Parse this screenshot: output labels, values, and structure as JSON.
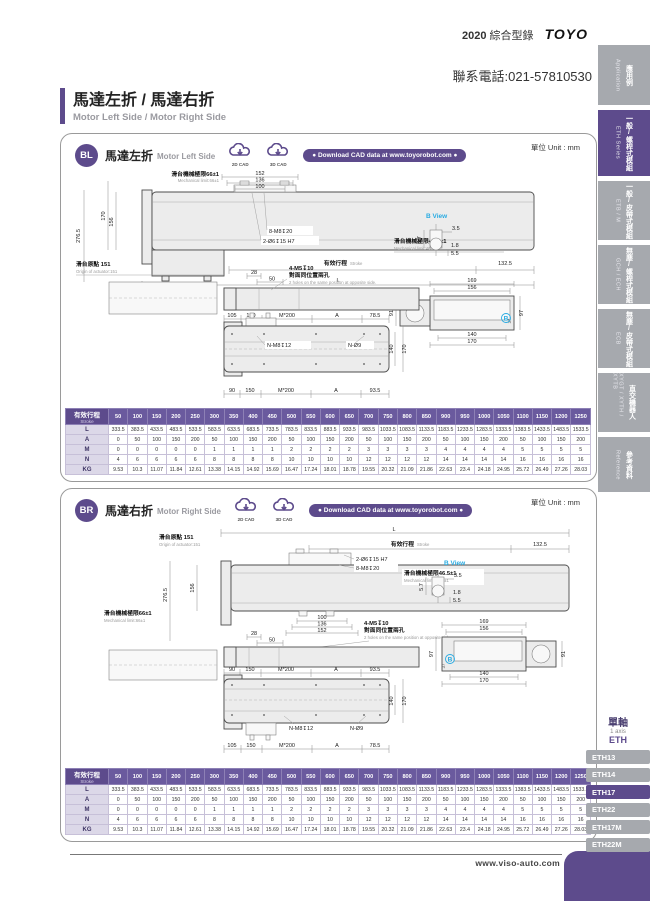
{
  "header": {
    "year": "2020",
    "catalog_zh": "綜合型錄",
    "logo": "TOYO",
    "phone": "聯系電話:021-57810530"
  },
  "title": {
    "zh": "馬達左折 / 馬達右折",
    "en": "Motor Left Side / Motor Right Side"
  },
  "sidebar_tabs": [
    {
      "zh": "應用例",
      "en": "Application"
    },
    {
      "zh": "一般/螺桿式模組",
      "en": "ETH Series"
    },
    {
      "zh": "一般/皮帶式模組",
      "en": "ETB / M"
    },
    {
      "zh": "無塵/螺桿式模組",
      "en": "GCH / ECH"
    },
    {
      "zh": "無塵/皮帶式模組",
      "en": "ECB"
    },
    {
      "zh": "直交機器人",
      "en": "XYGT / XYTH / XYTB"
    },
    {
      "zh": "參考資料",
      "en": "Reference"
    }
  ],
  "sections": [
    {
      "badge": "BL",
      "title_zh": "馬達左折",
      "title_en": "Motor Left Side",
      "unit": "單位 Unit : mm",
      "cad2d": "2D CAD",
      "cad3d": "3D CAD",
      "download": "● Download CAD data at www.toyorobot.com ●"
    },
    {
      "badge": "BR",
      "title_zh": "馬達右折",
      "title_en": "Motor Right Side",
      "unit": "單位 Unit : mm",
      "cad2d": "2D CAD",
      "cad3d": "3D CAD",
      "download": "● Download CAD data at www.toyorobot.com ●"
    }
  ],
  "drawing": {
    "mech66_zh": "滑台機械極限66±1",
    "mech66_en": "Mechanical limit:66±1",
    "mech465_zh": "滑台機械極限46.5±1",
    "mech465_en": "Mechanical limit:46.5±1",
    "origin_zh": "滑台原點 151",
    "origin_en": "Origin of actuator:151",
    "stroke_zh": "有效行程",
    "stroke_en": "Stroke",
    "L": "L",
    "d1325": "132.5",
    "d152": "152",
    "d136": "136",
    "d100": "100",
    "d2765": "276.5",
    "d170": "170",
    "d156": "156",
    "h8m8": "8-M8↧20",
    "h2o6": "2-Ø6↧15 H7",
    "h4m5": "4-M5↧10",
    "opp_zh": "對面同位置兩孔",
    "opp_en": "2 holes on the same position at opposite side.",
    "d28": "28",
    "d50": "50",
    "nm8": "N-M8↧12",
    "no9": "N-Ø9",
    "bview": "B View",
    "b": "B",
    "b35": "3.5",
    "b57": "5.7",
    "b18": "1.8",
    "b55": "5.5",
    "e169": "169",
    "e156": "156",
    "e140": "140",
    "e170": "170",
    "e91": "91",
    "e97": "97",
    "e37": "37",
    "m200": "M*200",
    "A": "A",
    "d105": "105",
    "d150": "150",
    "d785": "78.5",
    "d90": "90",
    "d935": "93.5"
  },
  "stroke_table": {
    "header_zh": "有效行程",
    "header_en": "Stroke",
    "strokes": [
      "50",
      "100",
      "150",
      "200",
      "250",
      "300",
      "350",
      "400",
      "450",
      "500",
      "550",
      "600",
      "650",
      "700",
      "750",
      "800",
      "850",
      "900",
      "950",
      "1000",
      "1050",
      "1100",
      "1150",
      "1200",
      "1250"
    ],
    "rows": [
      {
        "label": "L",
        "values": [
          "333.5",
          "383.5",
          "433.5",
          "483.5",
          "533.5",
          "583.5",
          "633.5",
          "683.5",
          "733.5",
          "783.5",
          "833.5",
          "883.5",
          "933.5",
          "983.5",
          "1033.5",
          "1083.5",
          "1133.5",
          "1183.5",
          "1233.5",
          "1283.5",
          "1333.5",
          "1383.5",
          "1433.5",
          "1483.5",
          "1533.5"
        ]
      },
      {
        "label": "A",
        "values": [
          "0",
          "50",
          "100",
          "150",
          "200",
          "50",
          "100",
          "150",
          "200",
          "50",
          "100",
          "150",
          "200",
          "50",
          "100",
          "150",
          "200",
          "50",
          "100",
          "150",
          "200",
          "50",
          "100",
          "150",
          "200"
        ]
      },
      {
        "label": "M",
        "values": [
          "0",
          "0",
          "0",
          "0",
          "0",
          "1",
          "1",
          "1",
          "1",
          "2",
          "2",
          "2",
          "2",
          "3",
          "3",
          "3",
          "3",
          "4",
          "4",
          "4",
          "4",
          "5",
          "5",
          "5",
          "5"
        ]
      },
      {
        "label": "N",
        "values": [
          "4",
          "6",
          "6",
          "6",
          "6",
          "8",
          "8",
          "8",
          "8",
          "10",
          "10",
          "10",
          "10",
          "12",
          "12",
          "12",
          "12",
          "14",
          "14",
          "14",
          "14",
          "16",
          "16",
          "16",
          "16"
        ]
      },
      {
        "label": "KG",
        "values": [
          "9.53",
          "10.3",
          "11.07",
          "11.84",
          "12.61",
          "13.38",
          "14.15",
          "14.92",
          "15.69",
          "16.47",
          "17.24",
          "18.01",
          "18.78",
          "19.55",
          "20.32",
          "21.09",
          "21.86",
          "22.63",
          "23.4",
          "24.18",
          "24.95",
          "25.72",
          "26.49",
          "27.26",
          "28.03"
        ]
      }
    ]
  },
  "series_nav": {
    "group_zh": "單軸",
    "group_en": "1 axis",
    "group_code": "ETH",
    "items": [
      "ETH13",
      "ETH14",
      "ETH17",
      "ETH22",
      "ETH17M",
      "ETH22M"
    ],
    "active": "ETH17"
  },
  "footer": {
    "url": "www.viso-auto.com"
  },
  "colors": {
    "purple": "#5d4b8c",
    "cyan": "#29abe2",
    "tab_gray": "#a6a9ae"
  }
}
